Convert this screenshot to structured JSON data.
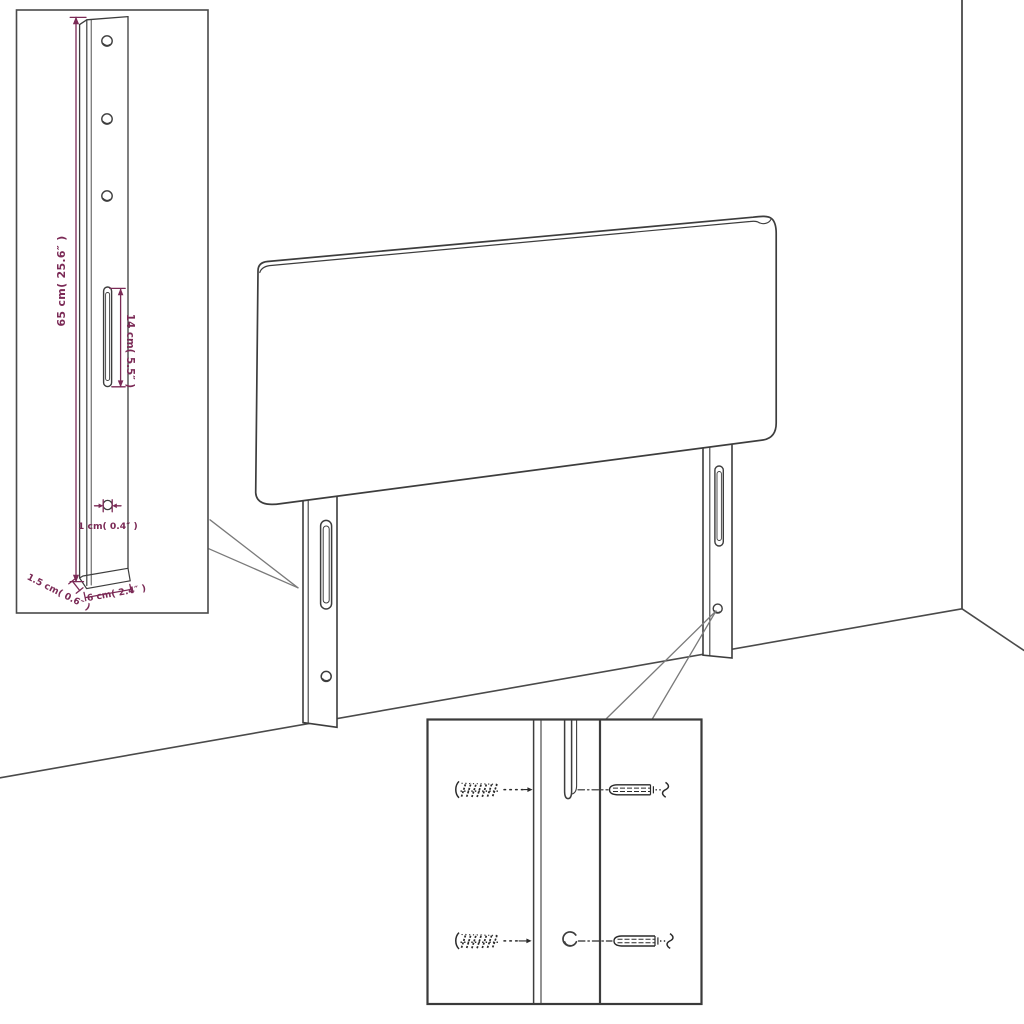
{
  "diagram": {
    "colors": {
      "background": "#ffffff",
      "line": "#3d3d3d",
      "frame": "#4a4a4a",
      "pointer": "#7a7a7a",
      "dimension": "#7b2a56",
      "hardware": "#2a2a2a"
    },
    "labels": {
      "leg_height": "65 cm( 25.6″ )",
      "slot_length": "14 cm( 5.5″ )",
      "hole_diameter": "1 cm( 0.4″ )",
      "leg_thickness": "1.5 cm( 0.6″ )",
      "leg_width": "6 cm( 2.4″ )"
    }
  }
}
